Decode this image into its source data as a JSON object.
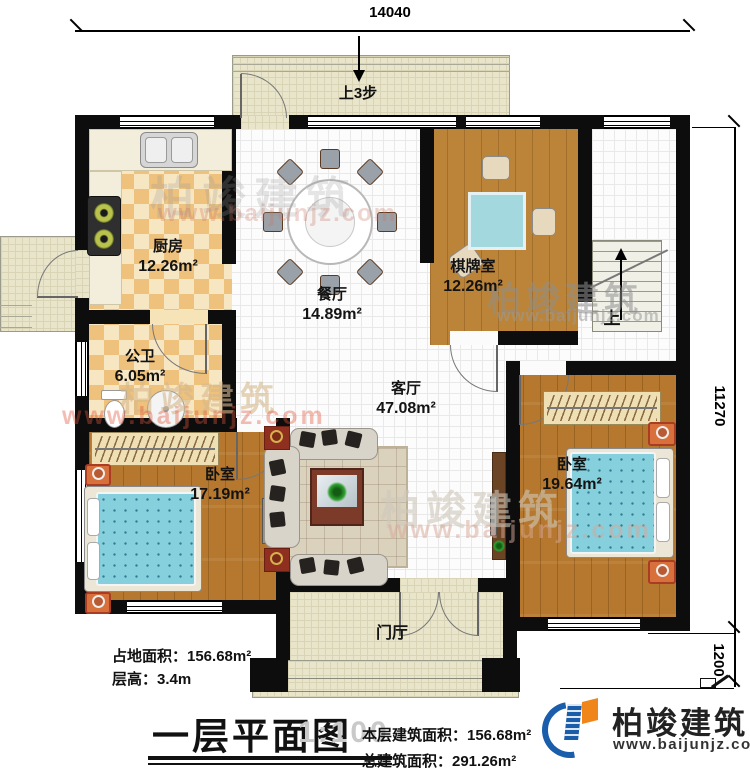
{
  "plan": {
    "dim_top": "14040",
    "dim_right_main": "11270",
    "dim_right_porch": "1200"
  },
  "rooms": [
    {
      "name": "厨房",
      "area": "12.26m²"
    },
    {
      "name": "餐厅",
      "area": "14.89m²"
    },
    {
      "name": "棋牌室",
      "area": "12.26m²"
    },
    {
      "name": "公卫",
      "area": "6.05m²"
    },
    {
      "name": "客厅",
      "area": "47.08m²"
    },
    {
      "name": "卧室",
      "area": "17.19m²"
    },
    {
      "name": "卧室",
      "area": "19.64m²"
    },
    {
      "name": "门厅",
      "area": ""
    }
  ],
  "annotations": {
    "porch_steps": "上3步",
    "stair_up": "上",
    "site_area": "占地面积：156.68m²",
    "floor_height": "层高：3.4m"
  },
  "title_block": {
    "title": "一层平面图",
    "scale": "1:100",
    "floor_area": "本层建筑面积：156.68m²",
    "total_area": "总建筑面积：291.26m²"
  },
  "brand": {
    "name": "柏竣建筑",
    "url": "www.baijunjz.com",
    "blue": "#1a5dab",
    "orange": "#f08619",
    "watermark_red": "#e0543a"
  }
}
